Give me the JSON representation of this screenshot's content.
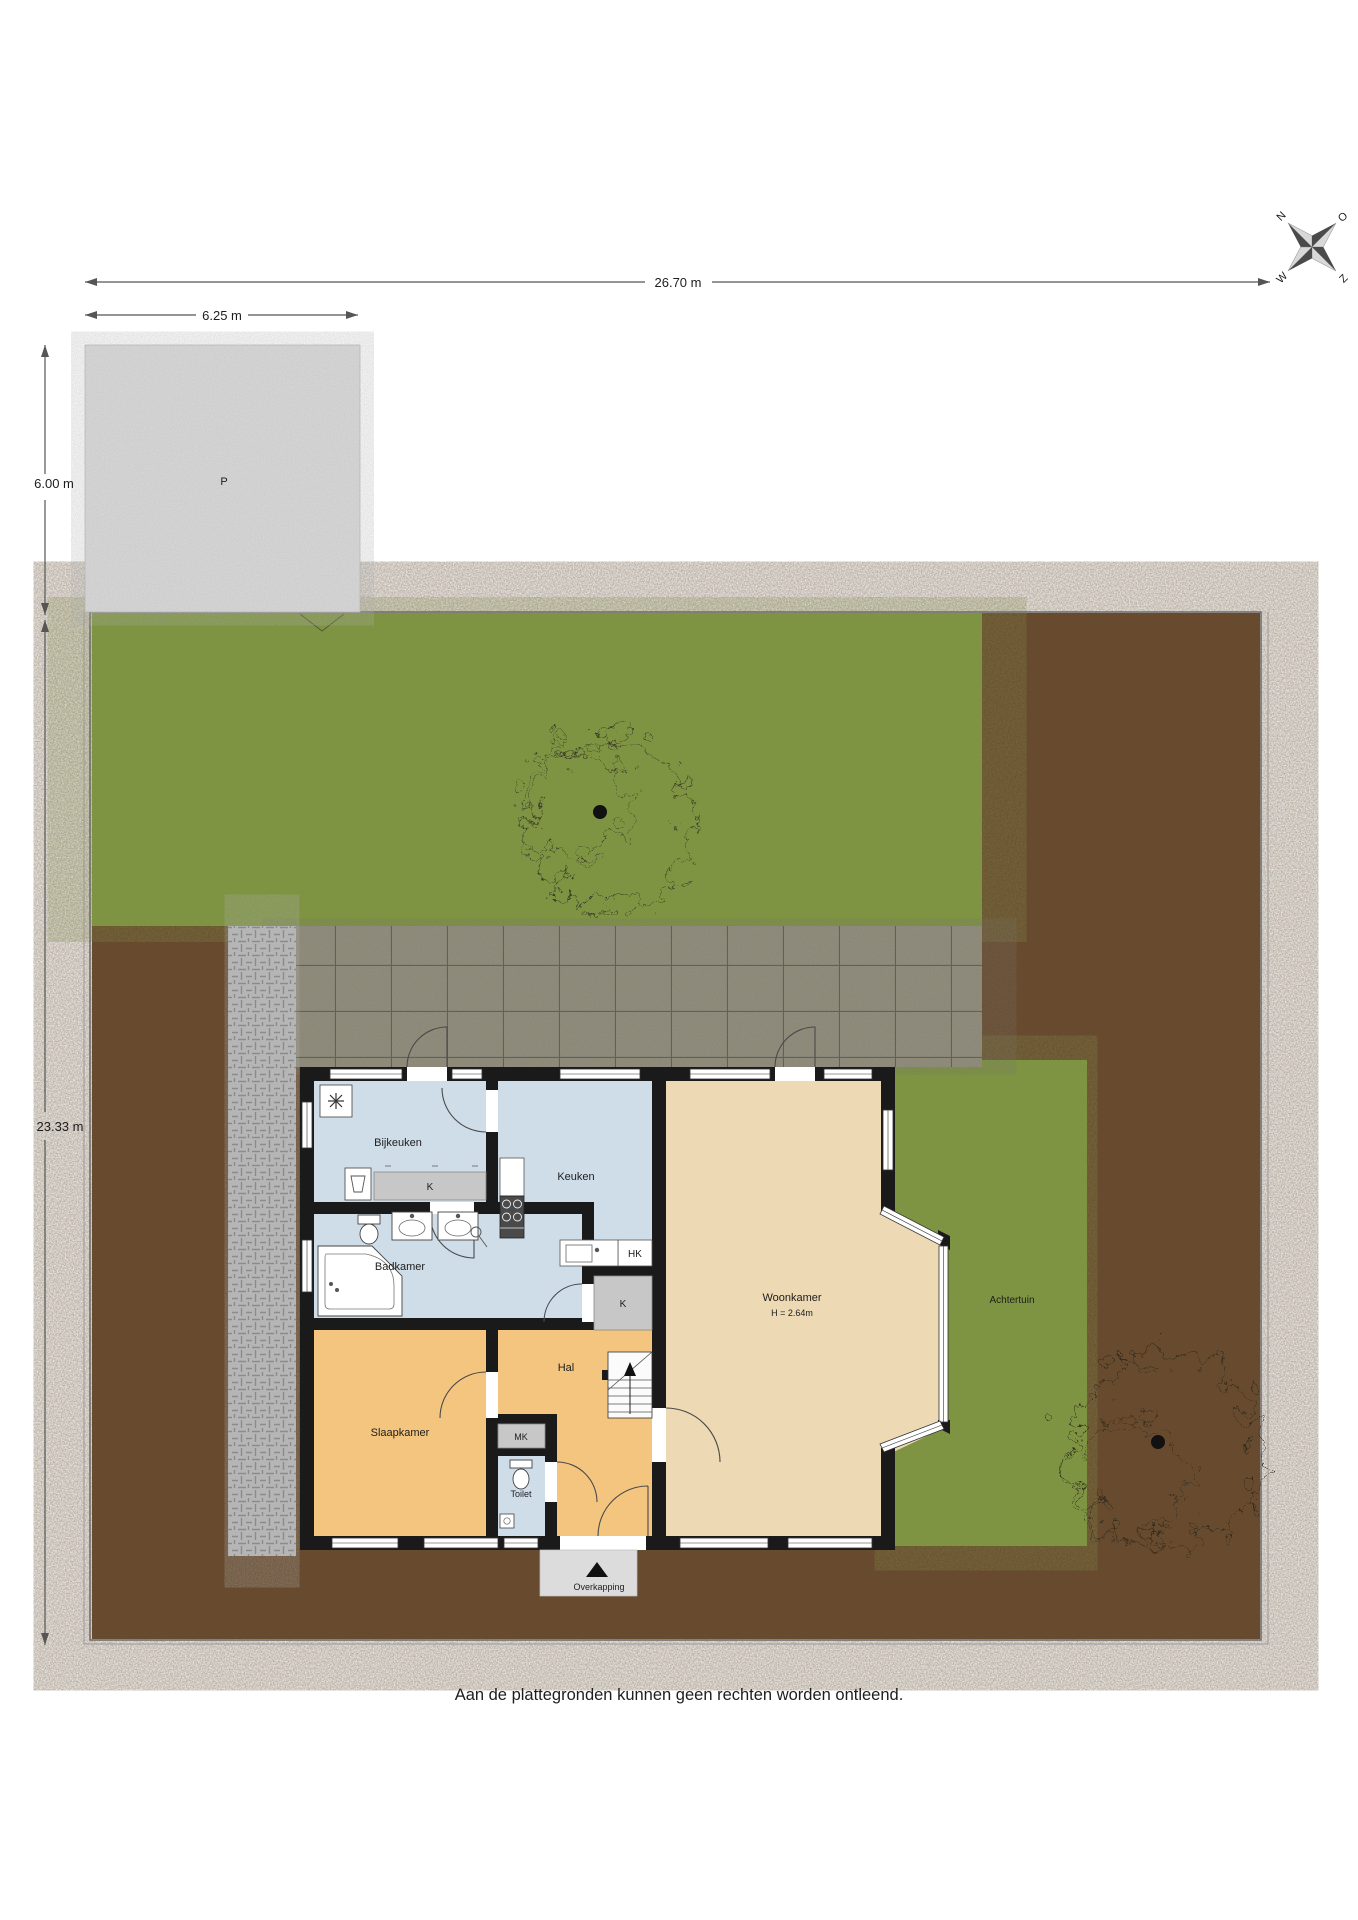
{
  "disclaimer": "Aan de plattegronden kunnen geen rechten worden ontleend.",
  "compass": {
    "north": "N",
    "east": "O",
    "south": "Z",
    "west": "W"
  },
  "dimensions": {
    "plot_width": "26.70 m",
    "parking_width": "6.25 m",
    "parking_depth": "6.00 m",
    "garden_depth": "23.33 m"
  },
  "site": {
    "parking_label": "P",
    "back_garden_label": "Achtertuin",
    "canopy_label": "Overkapping"
  },
  "rooms": {
    "utility": "Bijkeuken",
    "kitchen": "Keuken",
    "bathroom": "Badkamer",
    "bedroom": "Slaapkamer",
    "hall": "Hal",
    "toilet": "Toilet",
    "living": "Woonkamer",
    "living_height": "H = 2.64m",
    "closet_utility": "K",
    "closet_hall": "K",
    "closet_hk": "HK",
    "meter_cupboard": "MK"
  },
  "colors": {
    "grass": "#7d963f",
    "soil": "#6a4a2c",
    "paving": "#94907f",
    "path": "#b8b8b8",
    "parking": "#dbdbdb",
    "floor_living": "#edd9b3",
    "floor_dry_rooms": "#f4c57f",
    "floor_wet_rooms": "#cfdde9",
    "closet": "#c7c7c7",
    "wall": "#1a1a1a",
    "canopy": "#dcdcdc"
  }
}
